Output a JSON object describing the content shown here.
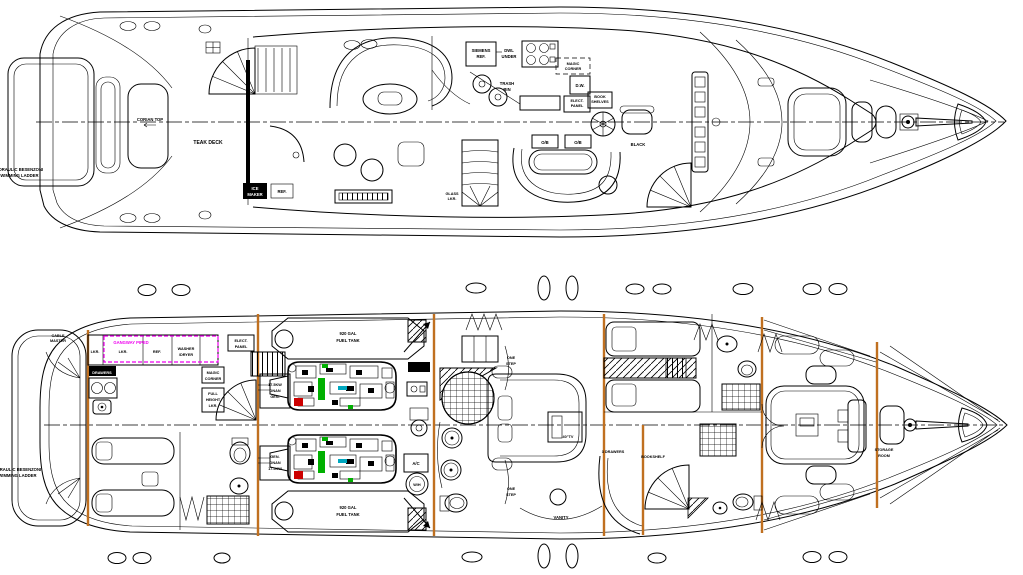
{
  "drawing": {
    "type": "yacht-general-arrangement",
    "views": [
      "main-deck-plan",
      "lower-deck-plan"
    ]
  },
  "colors": {
    "line": "#000000",
    "bulkhead_orange": "#c07020",
    "annotation_magenta": "#ee00ee",
    "engine_green": "#00b000",
    "engine_red": "#cc0000",
    "engine_cyan": "#00a8c0",
    "paper": "#ffffff"
  },
  "upper_deck": {
    "labels": {
      "ladder1": "HYDRAULIC BESENZONI",
      "ladder2": "SWIMMING LADDER",
      "corian": "CORIAN TOP",
      "teak": "TEAK DECK",
      "ice1": "ICE",
      "ice2": "MAKER",
      "ref": "REF.",
      "siemens1": "SIEMENS",
      "siemens2": "REF.",
      "dwl1": "DWL",
      "dwl2": "UNDER",
      "trash1": "TRASH",
      "trash2": "BIN",
      "magic1": "MAGIC",
      "magic2": "CORNER",
      "dw": "D.W.",
      "book1": "BOOK",
      "book2": "SHELVES",
      "elect1": "ELECT.",
      "elect2": "PANEL",
      "ob1": "O/B",
      "ob2": "O/B",
      "black": "BLACK",
      "glass1": "GLASS",
      "glass2": "LKR."
    }
  },
  "lower_deck": {
    "labels": {
      "ladder1": "HYDRAULIC BESENZONI",
      "ladder2": "SWIMMING LADDER",
      "cable1": "CABLE",
      "cable2": "MASTER",
      "gangway": "GANGWAY PIPED",
      "lkr_a": "LKR.",
      "lkr_b": "LKR.",
      "ref": "REF.",
      "washer1": "WASHER",
      "washer2": "/DRYER",
      "drawers": "DRAWERS",
      "elect1": "ELECT.",
      "elect2": "PANEL",
      "magic1": "MAGIC",
      "magic2": "CORNER",
      "full1": "FULL",
      "full2": "HEIGHT",
      "full3": "LKR.",
      "gen_fwd1": "17.5KW",
      "gen_fwd2": "ONAN",
      "gen_fwd3": "GEN.",
      "gen_aft1": "GEN.",
      "gen_aft2": "ONAN",
      "gen_aft3": "17.5KW",
      "fuel_top1": "920 GAL",
      "fuel_top2": "FUEL TANK",
      "fuel_bot1": "920 GAL",
      "fuel_bot2": "FUEL TANK",
      "ac": "A/C",
      "wh": "W/H",
      "step_fwd1": "ONE",
      "step_fwd2": "STEP",
      "step_aft1": "ONE",
      "step_aft2": "STEP",
      "tv": "40\"TV",
      "vanity": "VANITY",
      "drawers3": "3 DRAWERS",
      "bookshelf": "BOOKSHELF",
      "storage1": "STORAGE",
      "storage2": "ROOM"
    }
  }
}
